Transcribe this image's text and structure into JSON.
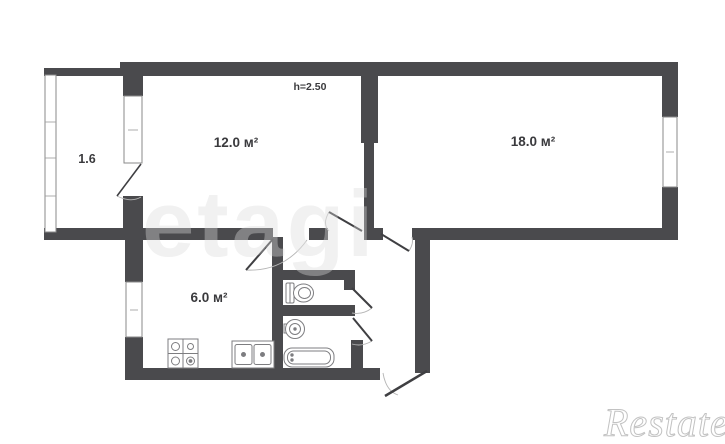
{
  "plan": {
    "labels": {
      "balcony": "1.6",
      "room_12": "12.0 м²",
      "room_18": "18.0 м²",
      "kitchen": "6.0 м²",
      "ceiling_height": "h=2.50"
    },
    "rooms": [
      {
        "name": "balcony",
        "area_label": "1.6"
      },
      {
        "name": "living-room-small",
        "area_label": "12.0 м²"
      },
      {
        "name": "living-room-large",
        "area_label": "18.0 м²"
      },
      {
        "name": "kitchen",
        "area_label": "6.0 м²"
      }
    ],
    "colors": {
      "wall": "#4a4a4d",
      "background": "#ffffff",
      "fixture_outline": "#7d7d80",
      "door_leaf": "#3f3f42",
      "door_arc": "#b5b5b5",
      "label_text": "#3a3a3d",
      "watermark_center": "#ebebeb",
      "watermark_corner": "#c2c2c2"
    }
  },
  "watermarks": {
    "etagi": "etagi",
    "restate": "Restate"
  }
}
